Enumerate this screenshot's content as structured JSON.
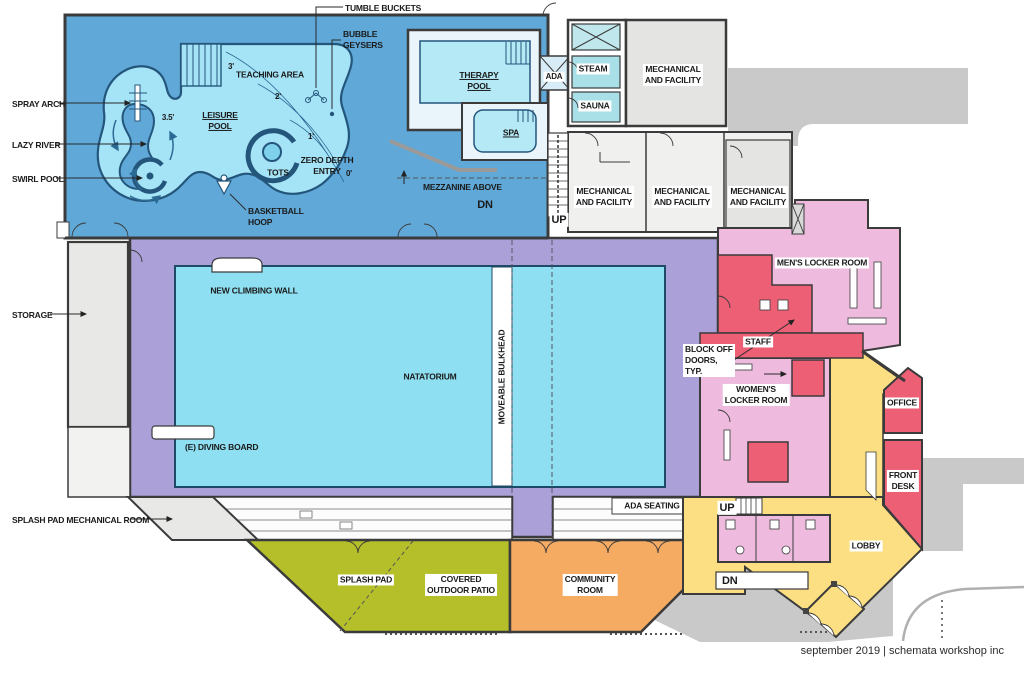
{
  "plan": {
    "footer": "september 2019 | schemata workshop inc",
    "labels": {
      "tumble_buckets": "TUMBLE BUCKETS",
      "bubble_geysers": "BUBBLE\nGEYSERS",
      "teaching_area": "TEACHING AREA",
      "leisure_pool": "LEISURE\nPOOL",
      "zero_depth_entry": "ZERO DEPTH\nENTRY",
      "tots": "TOTS",
      "basketball_hoop": "BASKETBALL\nHOOP",
      "spray_arch": "SPRAY ARCH",
      "lazy_river": "LAZY RIVER",
      "swirl_pool": "SWIRL POOL",
      "depth_3": "3'",
      "depth_2": "2'",
      "depth_1": "1'",
      "depth_0": "0'",
      "depth_3_5": "3.5'",
      "therapy_pool": "THERAPY\nPOOL",
      "spa": "SPA",
      "ada": "ADA",
      "steam": "STEAM",
      "sauna": "SAUNA",
      "mechanical": "MECHANICAL\nAND FACILITY",
      "mezzanine_above": "MEZZANINE ABOVE",
      "dn": "DN",
      "up": "UP",
      "storage": "STORAGE",
      "new_climbing_wall": "NEW CLIMBING WALL",
      "natatorium": "NATATORIUM",
      "moveable_bulkhead": "MOVEABLE BULKHEAD",
      "diving_board": "(E) DIVING BOARD",
      "mens_locker": "MEN'S LOCKER ROOM",
      "staff": "STAFF",
      "block_off_doors": "BLOCK OFF\nDOORS,\nTYP.",
      "womens_locker": "WOMEN'S\nLOCKER ROOM",
      "office": "OFFICE",
      "front_desk": "FRONT\nDESK",
      "lobby": "LOBBY",
      "ada_seating": "ADA SEATING",
      "splash_pad_mech": "SPLASH PAD MECHANICAL ROOM",
      "splash_pad": "SPLASH PAD",
      "covered_patio": "COVERED\nOUTDOOR PATIO",
      "community_room": "COMMUNITY\nROOM"
    }
  },
  "colors": {
    "pool_hall_blue": "#5fa8d8",
    "pool_water": "#a5e3f6",
    "lap_pool_water": "#8edff2",
    "therapy_water": "#b5e9f6",
    "steam_teal": "#a9dfe6",
    "deck_purple": "#aba1d8",
    "locker_pink": "#eebbdf",
    "accent_red": "#ed5f75",
    "lobby_yellow": "#fbdf82",
    "community_orange": "#f6ab63",
    "splash_olive": "#b4bf2a",
    "mechanical_gray": "#e4e4e2",
    "site_gray": "#c9c9c9"
  }
}
